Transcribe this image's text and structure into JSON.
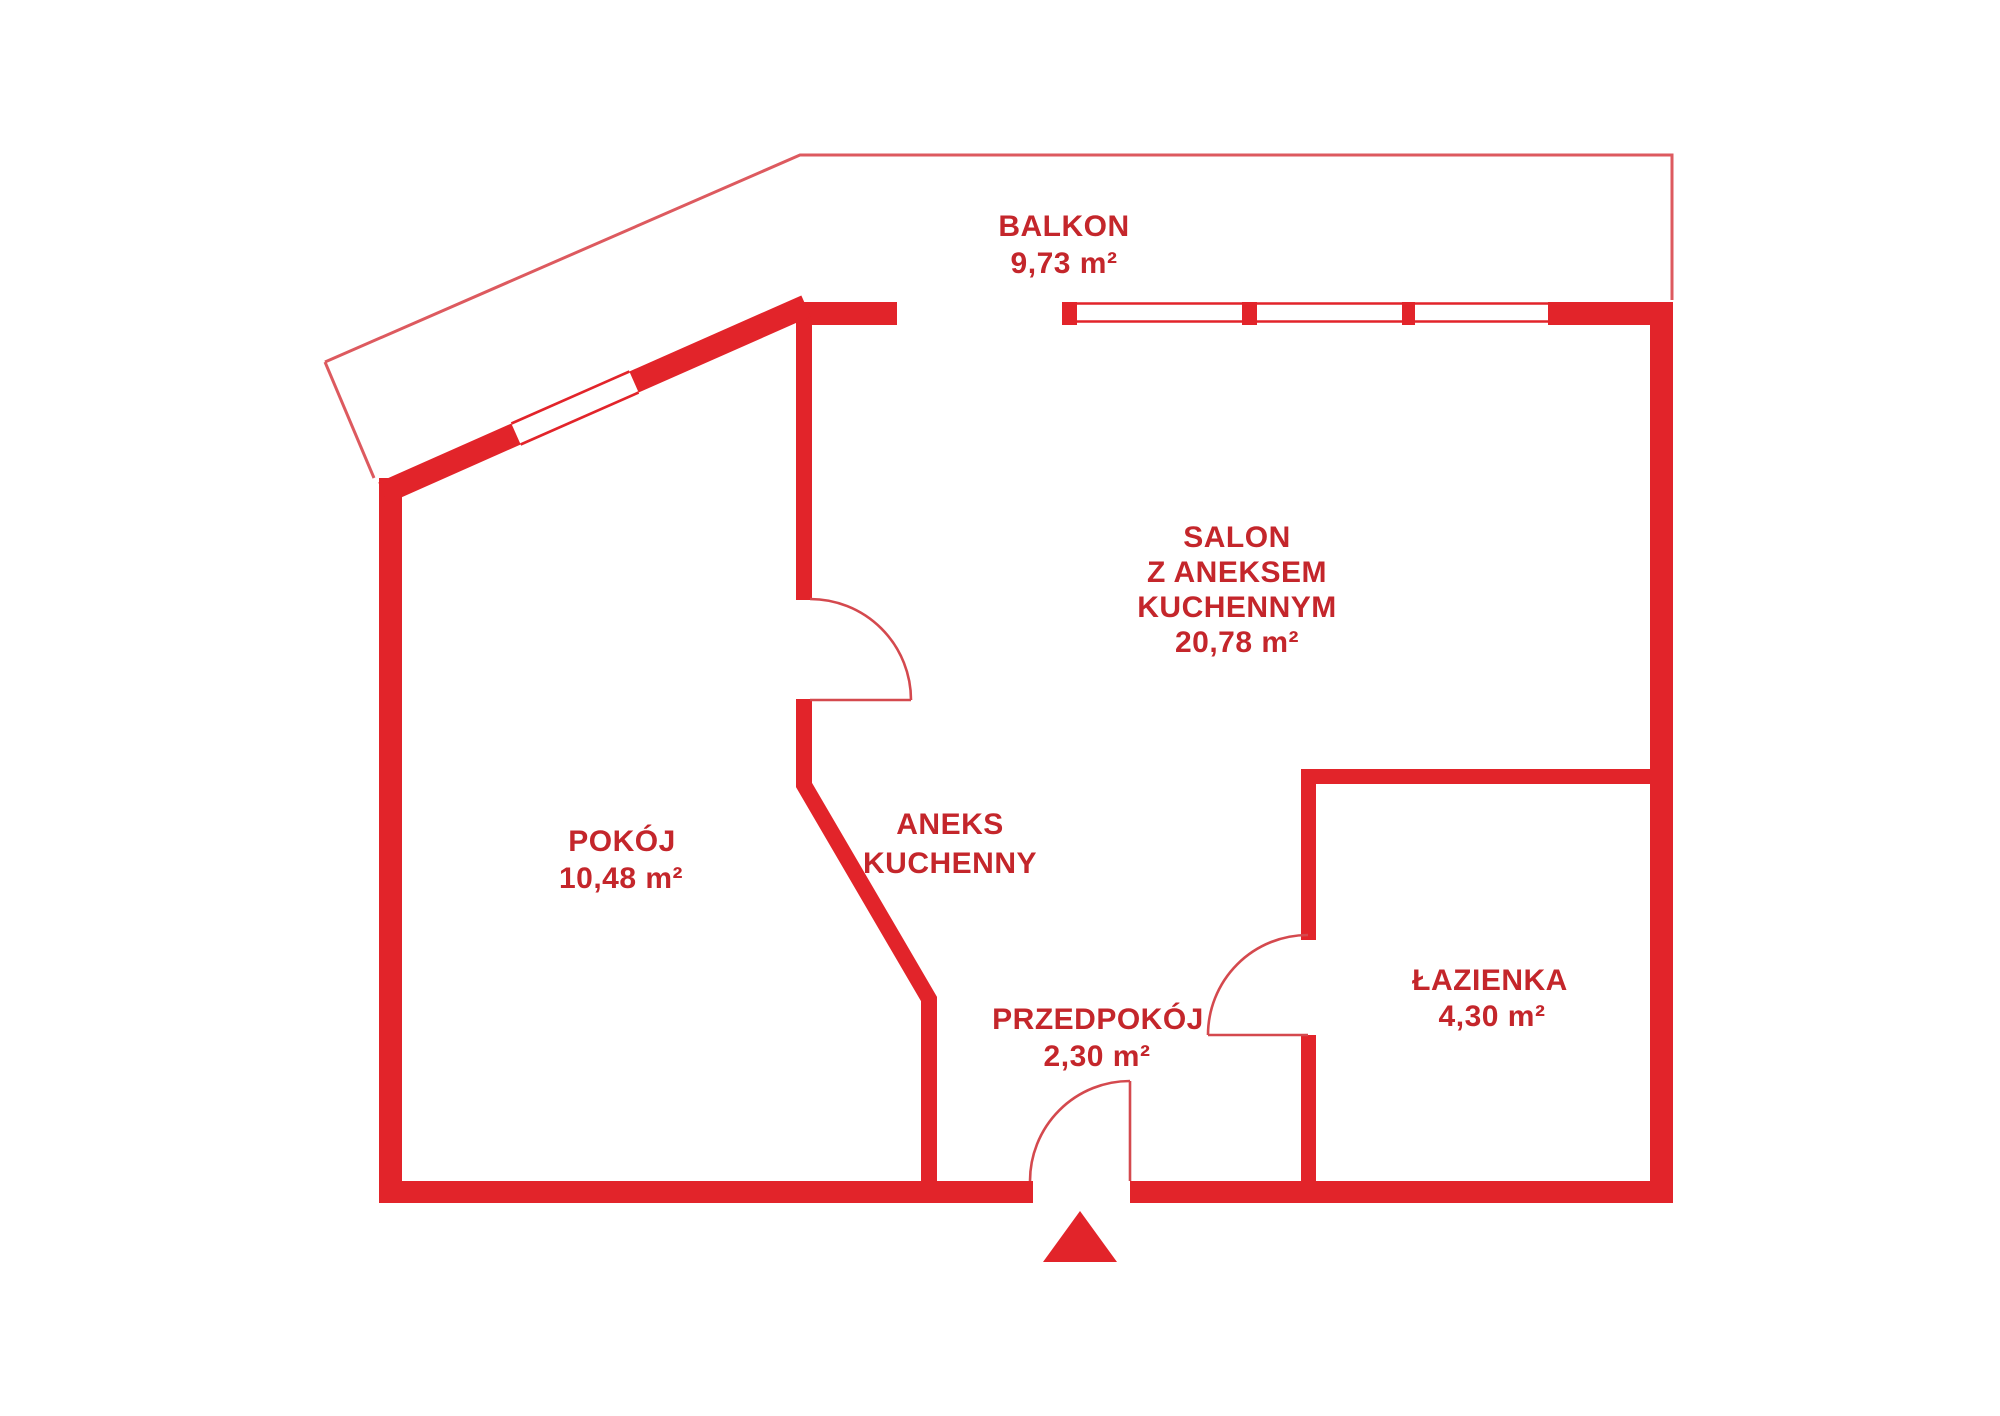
{
  "floorplan": {
    "type": "apartment-floor-plan",
    "colors": {
      "wall_red": "#e2242a",
      "outline_red": "#dd5a5f",
      "door_arc_red": "#d4494e",
      "text_red": "#c4262b",
      "background": "#ffffff"
    },
    "rooms": [
      {
        "id": "balkon",
        "label": "BALKON",
        "area": "9,73 m²"
      },
      {
        "id": "salon",
        "lines": [
          "SALON",
          "Z ANEKSEM",
          "KUCHENNYM"
        ],
        "area": "20,78 m²"
      },
      {
        "id": "pokoj",
        "label": "POKÓJ",
        "area": "10,48 m²"
      },
      {
        "id": "aneks-kuchenny",
        "lines": [
          "ANEKS",
          "KUCHENNY"
        ]
      },
      {
        "id": "przedpokoj",
        "label": "PRZEDPOKÓJ",
        "area": "2,30 m²"
      },
      {
        "id": "lazienka",
        "label": "ŁAZIENKA",
        "area": "4,30 m²"
      }
    ]
  }
}
